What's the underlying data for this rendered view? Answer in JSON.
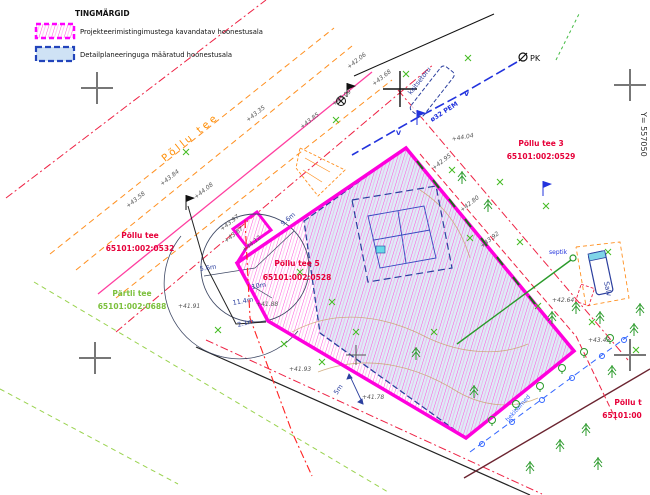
{
  "legend": {
    "title": "TINGMÄRGID",
    "items": [
      {
        "label": "Projekteerimistingimustega kavandatav hoonestusala",
        "swatch": "magenta-hatch"
      },
      {
        "label": "Detailplaneeringuga määratud hoonestusala",
        "swatch": "blue-dashed"
      }
    ]
  },
  "grid": {
    "y_coordinate_label": "Y= 557050"
  },
  "road_name": "Põllu tee",
  "parcels": {
    "road": {
      "name": "Põllu tee",
      "cadastre": "65101:002:0532"
    },
    "partli": {
      "name": "Pärtli tee",
      "cadastre": "65101:002:0688"
    },
    "site": {
      "name": "Põllu tee 5",
      "cadastre": "65101:002:0528"
    },
    "neighbor_east": {
      "name": "Põllu tee 3",
      "cadastre": "65101:002:0529"
    },
    "neighbor_corner": {
      "name": "Põllu t",
      "cadastre": "65101:00"
    }
  },
  "survey": {
    "pk": "PK"
  },
  "utilities": {
    "pipe": "ø32 PEM",
    "casing": "kaitsetoru",
    "septic": "septik",
    "well": "Salv",
    "hedge": "hekitaimed",
    "v1": "V",
    "v2": "V"
  },
  "dimensions": {
    "r96": "9.6m",
    "r56": "5.6m",
    "r114": "11.4m",
    "r10": "10m",
    "r21": "2.1m",
    "offset5": "5m"
  },
  "elevations": [
    "+43.35",
    "+43.84",
    "+43.58",
    "+44.08",
    "+43.97",
    "+43.87",
    "+44.12",
    "+43.85",
    "+43.09",
    "+42.06",
    "+43.68",
    "+44.04",
    "+42.95",
    "+42.80",
    "+43.92",
    "+43.43",
    "+41.91",
    "+41.88",
    "+41.93",
    "+41.78",
    "+42.64"
  ],
  "colors": {
    "boundary_magenta": "#ff00dd",
    "detail_plan_blue": "#2b3f9e",
    "cadastral_red": "#e60039",
    "road_orange": "#ff8c00",
    "vegetation_green": "#2a9a2a",
    "partli_green": "#7cc03c",
    "water_blue": "#2233dd",
    "hatch_pink": "#ff4fd8",
    "area_fill_blue": "#d9e8f6"
  }
}
